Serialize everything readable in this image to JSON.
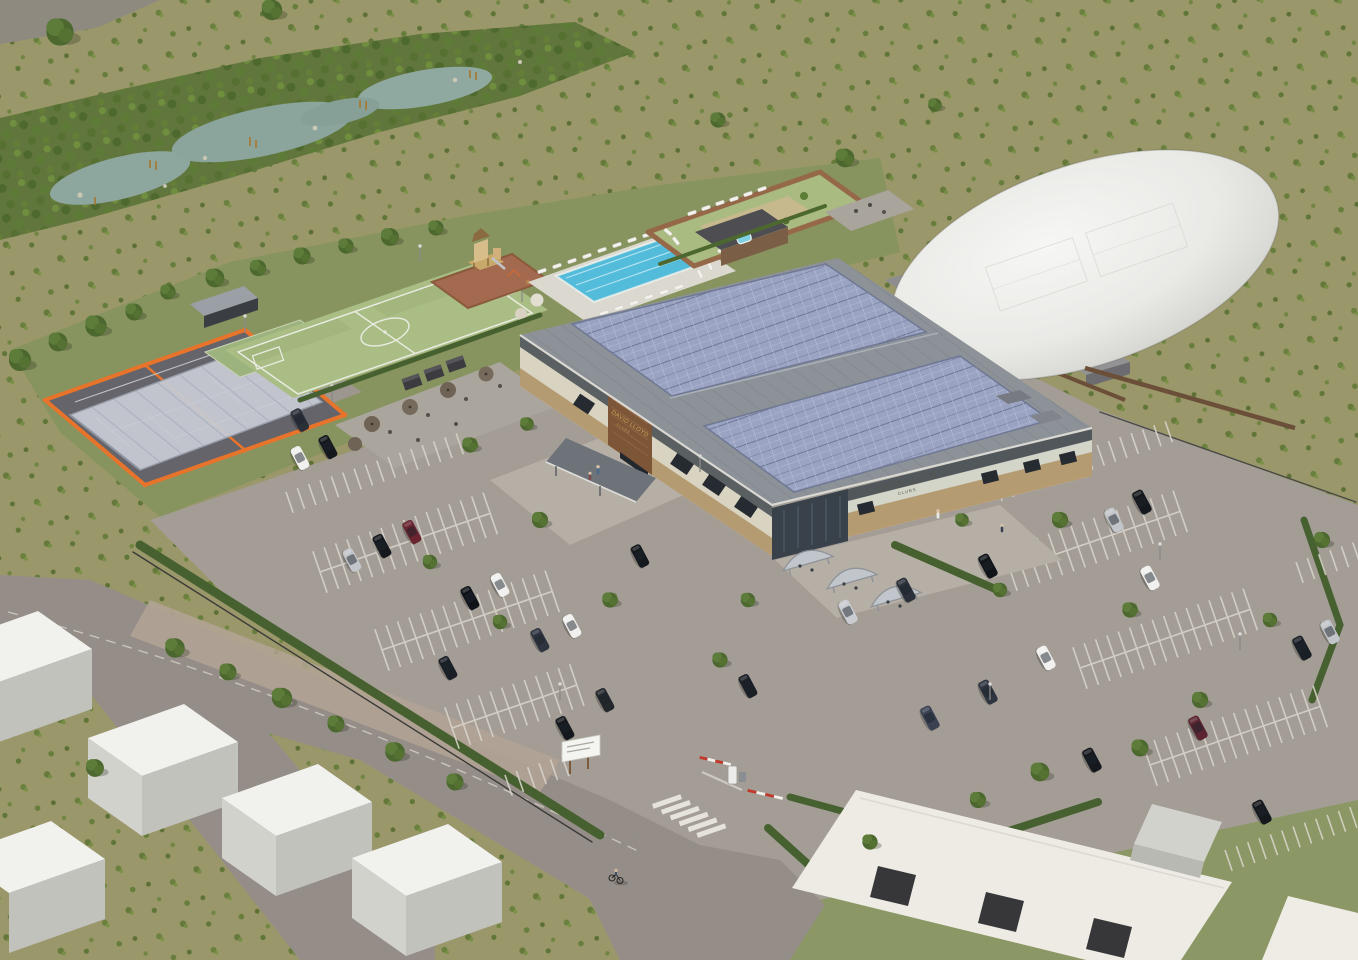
{
  "image": {
    "type": "aerial-architectural-render",
    "description": "Computer-generated aerial view of a David Lloyd Clubs leisure campus: wetland corridor, covered padel courts, artificial pitch, adventure playground, outdoor pool, walled spa garden, solar-roofed clubhouse, tennis air dome, car parks and access roads"
  },
  "signage": {
    "brand": "DAVID LLOYD",
    "suffix": "CLUBS"
  },
  "palette": {
    "scrubland": "#9a976a",
    "lush_green": "#61763c",
    "water": "#8ea79e",
    "pitch_green": "#a9bd85",
    "padel_orange": "#e8732a",
    "pool_blue": "#45b5d6",
    "solar_panel": "#9aa3c2",
    "roof_grey": "#8d9298",
    "wall_cream": "#d9d4c2",
    "brick_tan": "#b59b72",
    "timber_brown": "#7d5638",
    "dome_white": "#ededeb",
    "tarmac": "#a39d96",
    "road_grey": "#958e88",
    "marking_white": "#d9d5cc",
    "hedge_green": "#46602f"
  },
  "scene": {
    "areas": [
      {
        "name": "wetland-corridor",
        "label": "wetland and pond corridor"
      },
      {
        "name": "scrub-meadow",
        "label": "scrub meadow"
      },
      {
        "name": "padel-courts",
        "label": "covered padel courts"
      },
      {
        "name": "football-pitch",
        "label": "artificial turf pitch"
      },
      {
        "name": "playground",
        "label": "adventure playground"
      },
      {
        "name": "outdoor-pool",
        "label": "outdoor swimming pool"
      },
      {
        "name": "spa-garden",
        "label": "walled spa garden"
      },
      {
        "name": "club-terrace",
        "label": "club terrace"
      },
      {
        "name": "clubhouse",
        "label": "clubhouse with solar roof"
      },
      {
        "name": "tennis-dome",
        "label": "tennis air dome"
      },
      {
        "name": "car-park-west",
        "label": "west car park"
      },
      {
        "name": "car-park-east",
        "label": "east car park"
      },
      {
        "name": "site-entrance",
        "label": "entrance barrier and zebra crossing"
      },
      {
        "name": "neighbouring-units",
        "label": "neighbouring white units"
      }
    ]
  }
}
